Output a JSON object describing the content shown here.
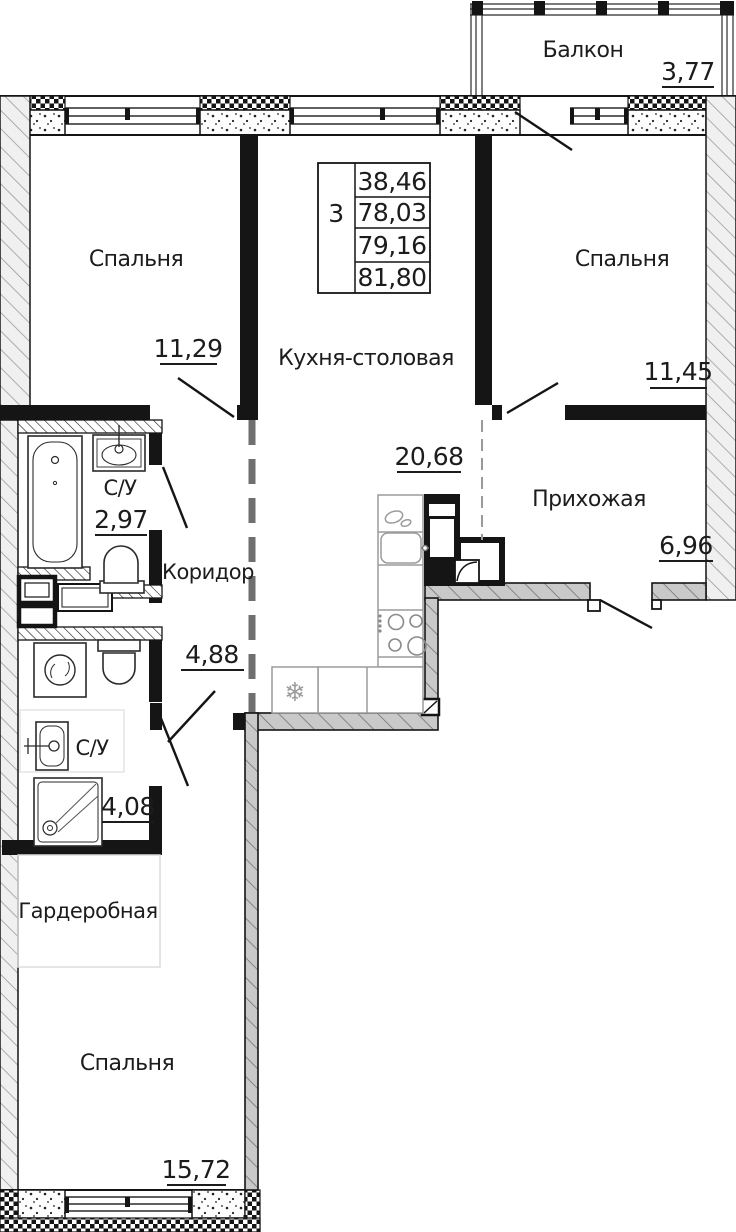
{
  "plan": {
    "table": {
      "rooms_count": "3",
      "rows": [
        "38,46",
        "78,03",
        "79,16",
        "81,80"
      ]
    },
    "rooms": {
      "balcony": {
        "label": "Балкон",
        "area": "3,77"
      },
      "bedroom_top_left": {
        "label": "Спальня",
        "area": "11,29"
      },
      "kitchen": {
        "label": "Кухня-столовая",
        "area": "20,68"
      },
      "bedroom_top_right": {
        "label": "Спальня",
        "area": "11,45"
      },
      "hallway": {
        "label": "Прихожая",
        "area": "6,96"
      },
      "bathroom_small": {
        "label": "С/У",
        "area": "2,97"
      },
      "corridor": {
        "label": "Коридор",
        "area": "4,88"
      },
      "bathroom_big": {
        "label": "С/У",
        "area": "4,08"
      },
      "wardrobe": {
        "label": "Гардеробная"
      },
      "bedroom_bottom": {
        "label": "Спальня",
        "area": "15,72"
      }
    },
    "icons": {
      "fridge_snowflake": "❄"
    },
    "colors": {
      "wall_dark": "#151515",
      "wall_gray_fill": "#c9c9c9",
      "exterior_wall_fill": "#f0f0f0",
      "counter_line": "#9b9b9b",
      "zone_outline": "#dcdcdc",
      "text": "#1c1c1c",
      "background": "#ffffff"
    }
  }
}
